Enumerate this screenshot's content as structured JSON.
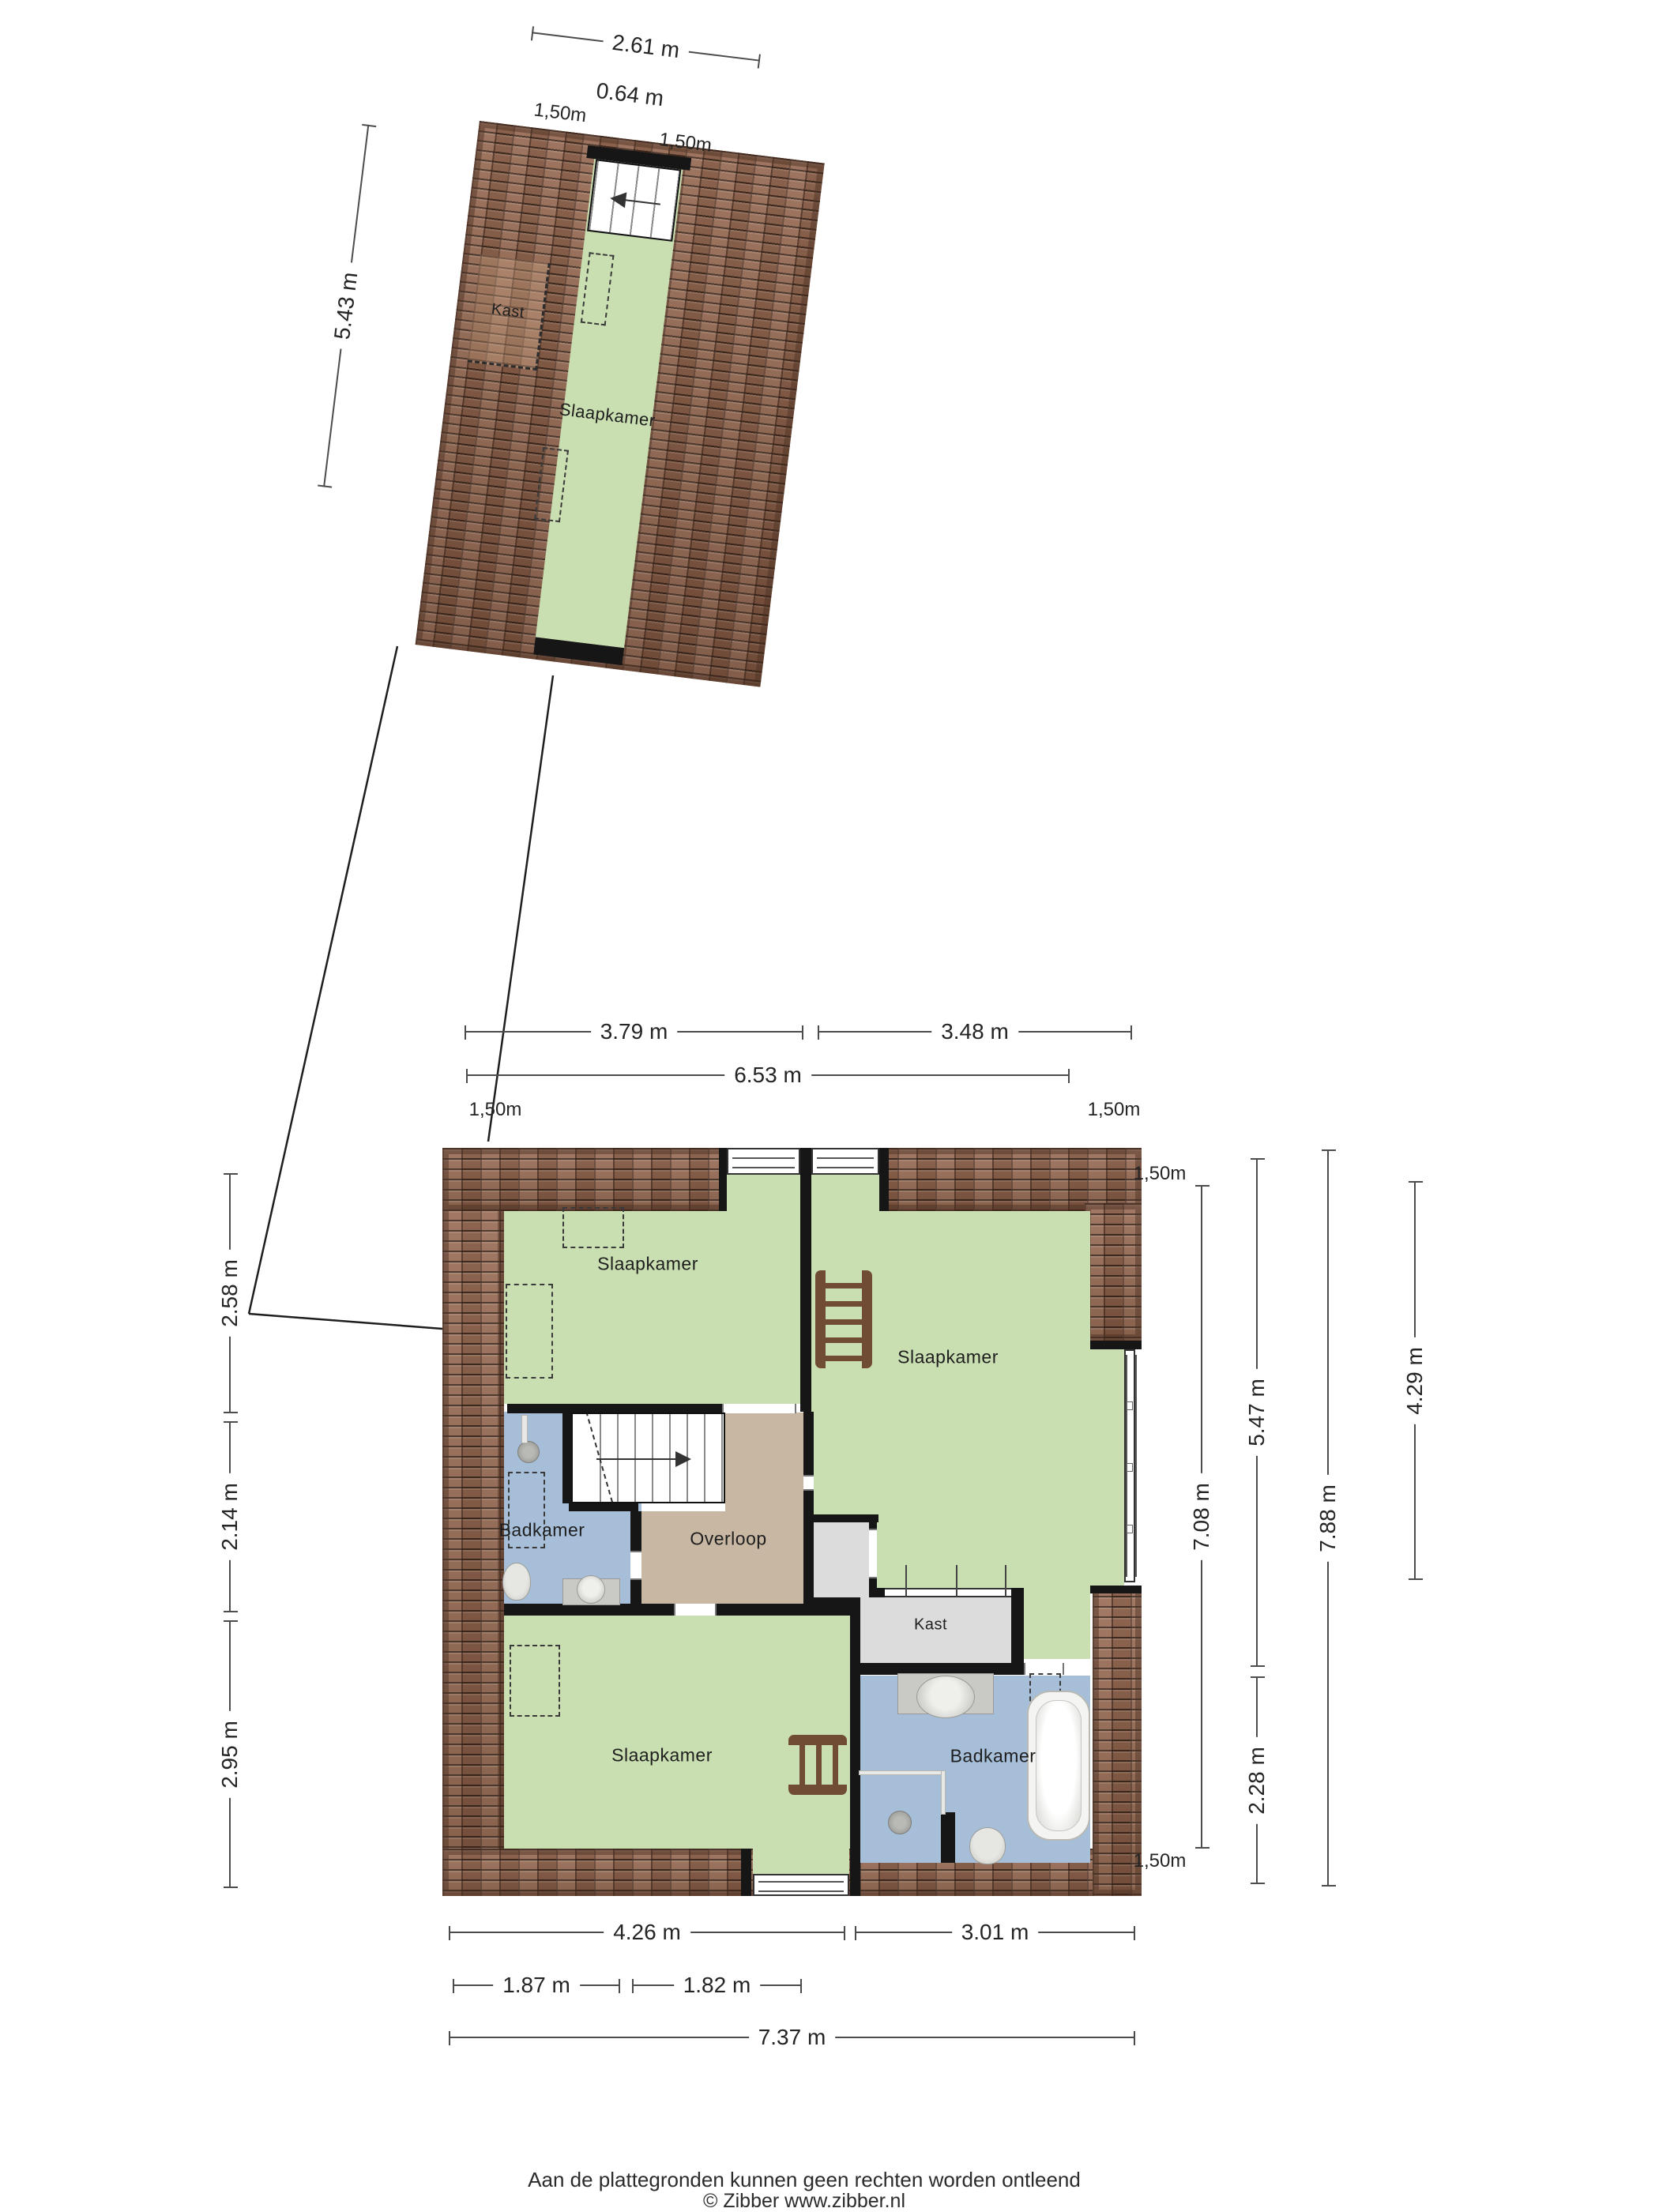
{
  "footer": {
    "line1": "Aan de plattegronden kunnen geen rechten worden ontleend",
    "line2": "© Zibber www.zibber.nl"
  },
  "attic": {
    "rooms": {
      "kast": "Kast",
      "slaapkamer": "Slaapkamer"
    },
    "dims": {
      "width": "2.61 m",
      "stair_width": "0.64 m",
      "knee_left": "1,50m",
      "knee_right": "1,50m",
      "depth": "5.43 m"
    }
  },
  "floor": {
    "rooms": {
      "bedroom_top_left": "Slaapkamer",
      "bedroom_right": "Slaapkamer",
      "bedroom_bottom_left": "Slaapkamer",
      "bathroom_left": "Badkamer",
      "bathroom_right": "Badkamer",
      "landing": "Overloop",
      "closet": "Kast"
    },
    "dims_top": {
      "left": "3.79 m",
      "right": "3.48 m",
      "total": "6.53 m",
      "knee_left": "1,50m",
      "knee_right": "1,50m"
    },
    "dims_left": {
      "top": "2.58 m",
      "middle": "2.14 m",
      "bottom": "2.95 m"
    },
    "dims_right": {
      "knee_top": "1,50m",
      "col1": "7.08 m",
      "knee_bottom": "1,50m",
      "col2_top": "5.47 m",
      "col2_bottom": "2.28 m",
      "col3": "7.88 m",
      "col4": "4.29 m"
    },
    "dims_bottom": {
      "left": "4.26 m",
      "right": "3.01 m",
      "sub_left": "1.87 m",
      "sub_right": "1.82 m",
      "total": "7.37 m"
    }
  },
  "colors": {
    "room_green": "#c9dfb1",
    "bath_blue": "#a6bed8",
    "landing_tan": "#c8b8a3",
    "closet_gray": "#dcdcdc",
    "wall": "#161616",
    "tile_base": "#8a5f49",
    "dim_line": "#4c4c4c"
  }
}
